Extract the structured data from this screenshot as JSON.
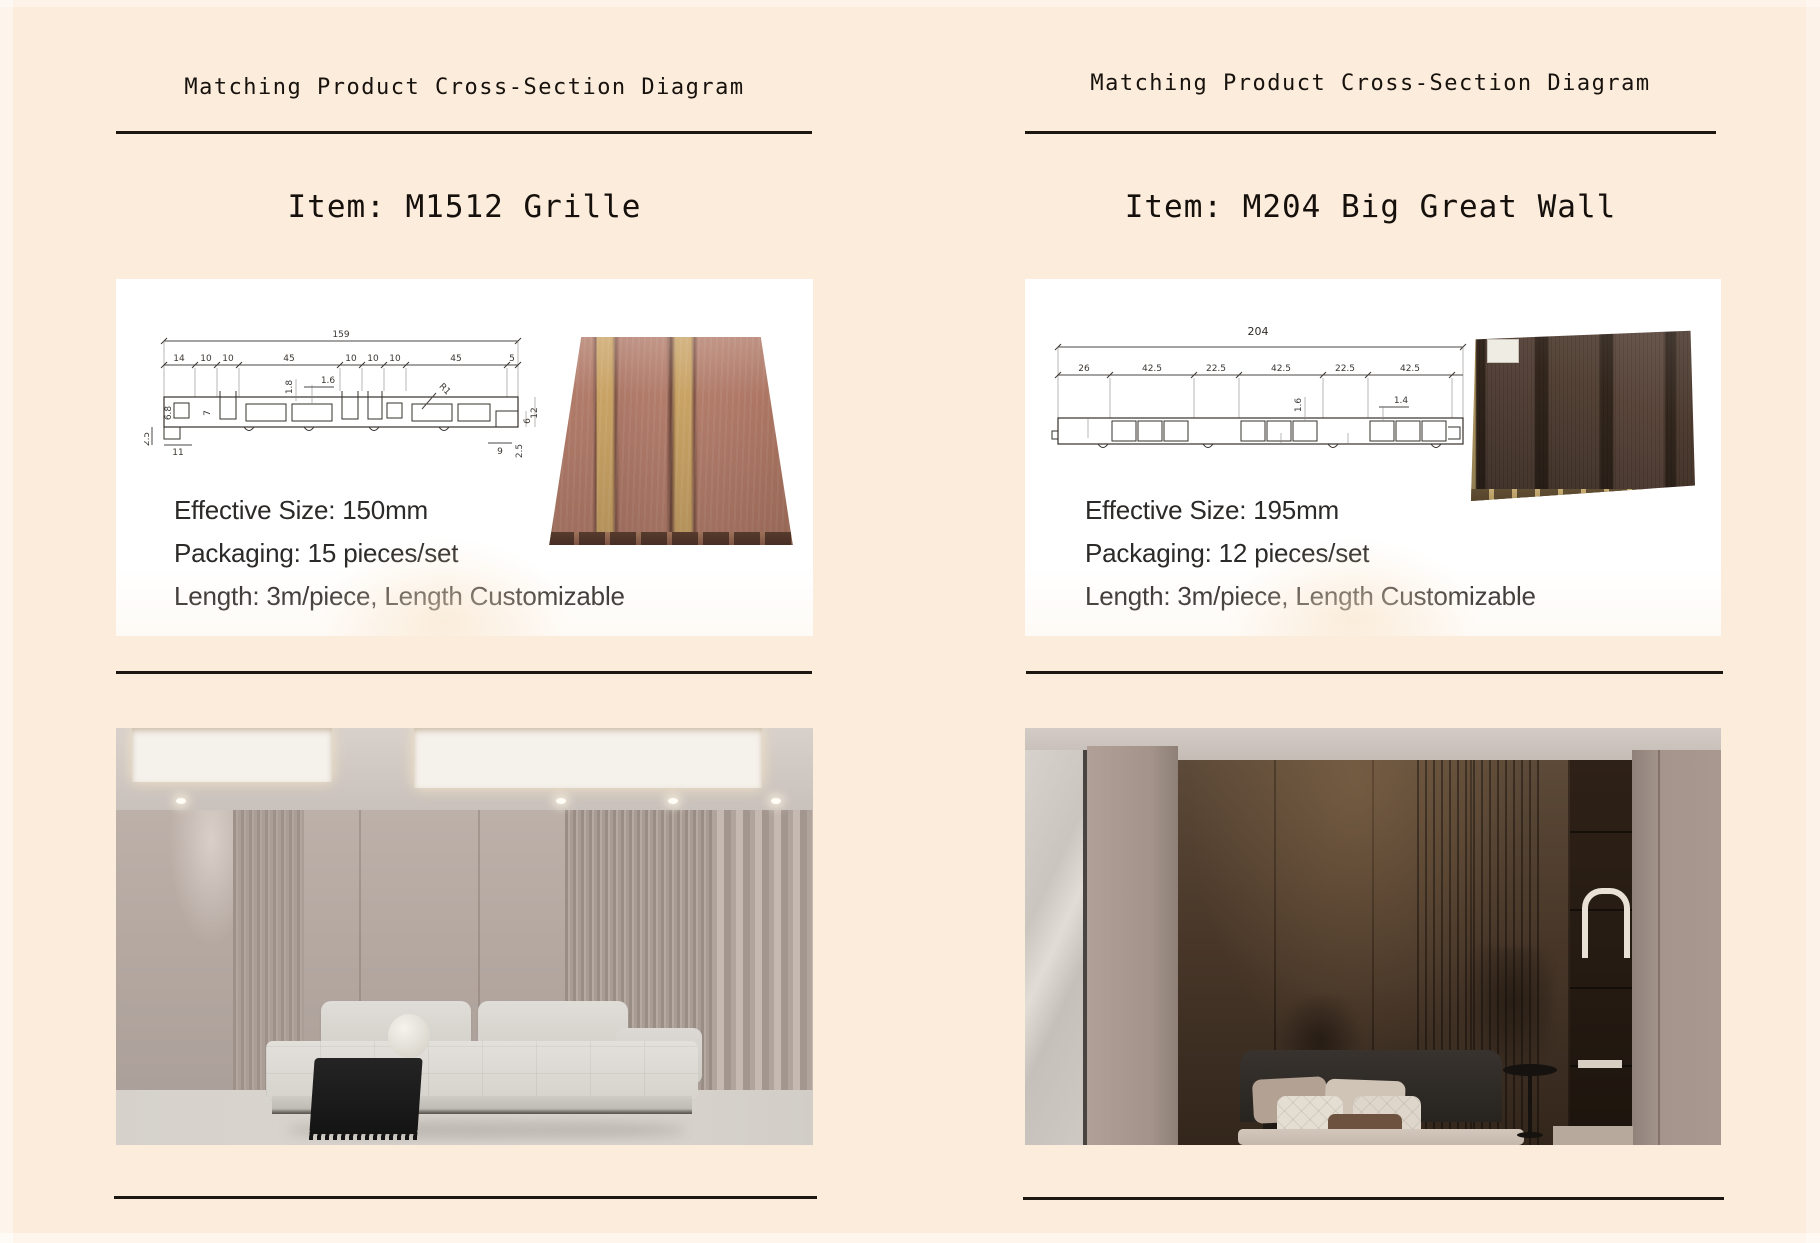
{
  "page": {
    "background_color": "#fcecdb",
    "rule_color": "#1d1712"
  },
  "left_section": {
    "header": "Matching Product Cross-Section Diagram",
    "item_title": "Item: M1512 Grille",
    "specs": [
      "Effective Size: 150mm",
      "Packaging: 15 pieces/set",
      "Length: 3m/piece, Length Customizable"
    ],
    "diagram": {
      "total_width": "159",
      "top_dims": [
        "14",
        "10",
        "10",
        "45",
        "10",
        "10",
        "10",
        "45",
        "5"
      ],
      "thickness_dims": {
        "rib_height": "1.8",
        "rib_width": "1.6",
        "left_depth": "6.8",
        "slot_depth": "7",
        "radius": "R1",
        "base_left": "2.5",
        "base_width": "11",
        "right_width": "9",
        "right_small": "2.5",
        "right_mid": "6",
        "right_height": "12"
      }
    },
    "product_colors": {
      "wood": "#b17b69",
      "strip": "#c9a365"
    }
  },
  "right_section": {
    "header": "Matching Product Cross-Section Diagram",
    "item_title": "Item: M204 Big Great Wall",
    "specs": [
      "Effective Size: 195mm",
      "Packaging: 12 pieces/set",
      "Length: 3m/piece, Length Customizable"
    ],
    "diagram": {
      "total_width": "204",
      "top_dims": [
        "26",
        "42.5",
        "22.5",
        "42.5",
        "22.5",
        "42.5"
      ],
      "thickness_dims": {
        "rib_height": "1.6",
        "rib_width": "1.4"
      }
    },
    "product_colors": {
      "wood": "#544236",
      "edge": "#c2a76c"
    }
  }
}
